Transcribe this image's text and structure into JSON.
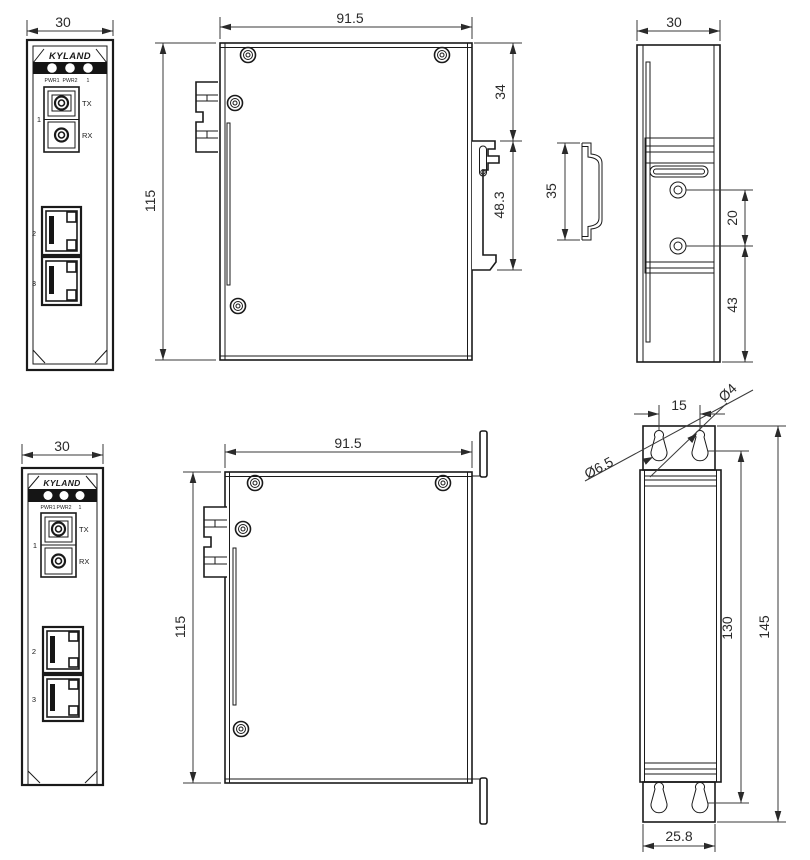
{
  "panel": {
    "brand": "KYLAND",
    "led_pwr1": "PWR1",
    "led_pwr2": "PWR2",
    "led_port1": "1",
    "fiber_port": "1",
    "tx": "TX",
    "rx": "RX",
    "port2": "2",
    "port3": "3"
  },
  "dims": {
    "din_front_width": "30",
    "din_depth": "91.5",
    "din_height": "115",
    "din_clip_offset": "34",
    "din_clip_length": "48.3",
    "din_rail_height": "35",
    "din_rear_width": "30",
    "din_hole_spacing": "20",
    "din_hole_to_bottom": "43",
    "wall_front_width": "30",
    "wall_depth": "91.5",
    "wall_height": "115",
    "wall_keyhole_spacing": "15",
    "wall_small_hole_dia": "Ø4",
    "wall_large_hole_dia": "Ø6.5",
    "wall_hole_span": "130",
    "wall_overall_height": "145",
    "wall_bracket_width": "25.8"
  },
  "colors": {
    "line": "#1a1a1a",
    "background": "#ffffff"
  }
}
